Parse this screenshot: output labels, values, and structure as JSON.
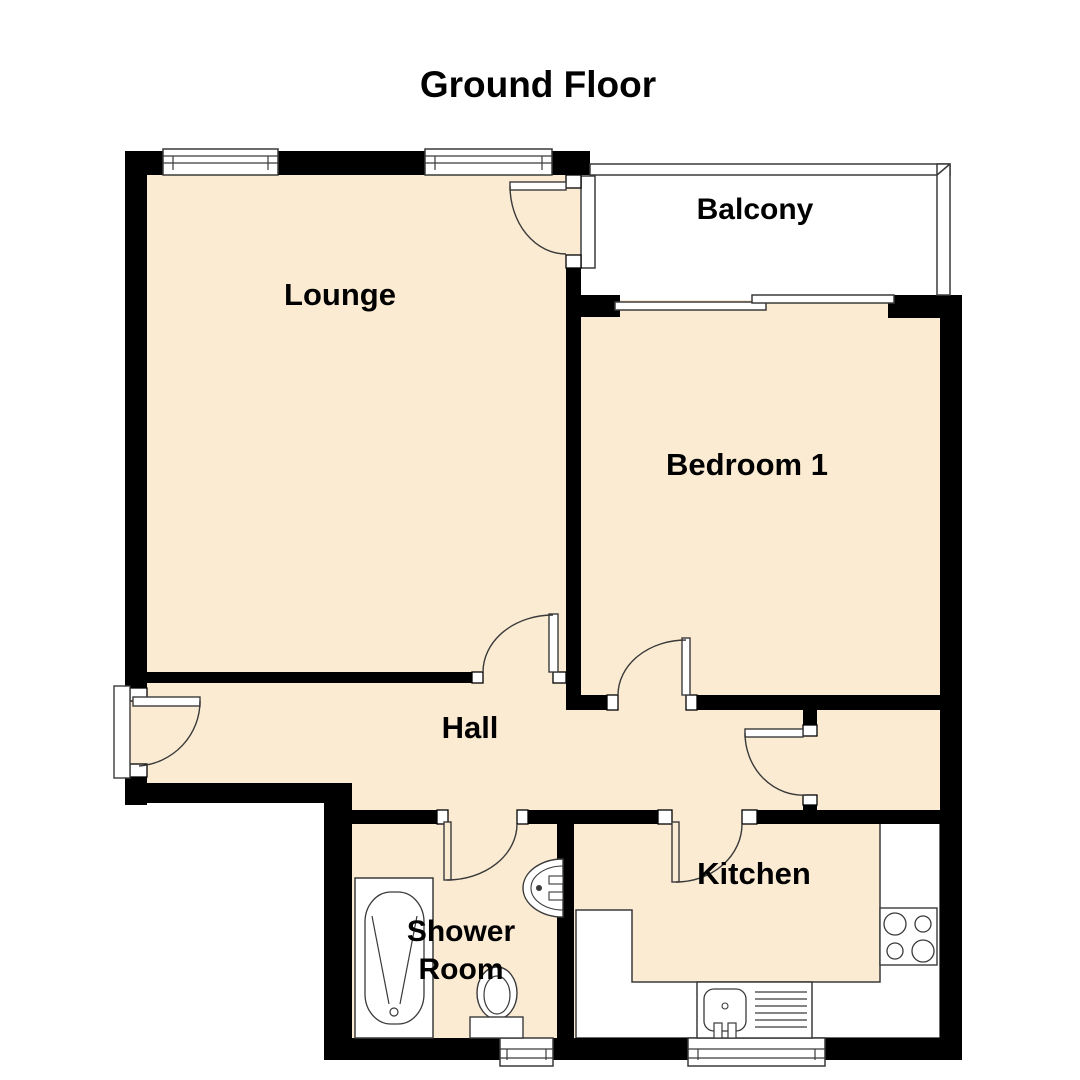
{
  "title": "Ground Floor",
  "floorplan": {
    "rooms": [
      {
        "id": "lounge",
        "label": "Lounge"
      },
      {
        "id": "balcony",
        "label": "Balcony"
      },
      {
        "id": "bedroom1",
        "label": "Bedroom 1"
      },
      {
        "id": "hall",
        "label": "Hall"
      },
      {
        "id": "shower_room",
        "label": "Shower Room",
        "lines": [
          "Shower",
          "Room"
        ]
      },
      {
        "id": "kitchen",
        "label": "Kitchen"
      }
    ],
    "colors": {
      "floor_fill": "#FAEBD2",
      "wall": "#000000",
      "outline": "#3a3a3a",
      "background": "#ffffff"
    }
  }
}
